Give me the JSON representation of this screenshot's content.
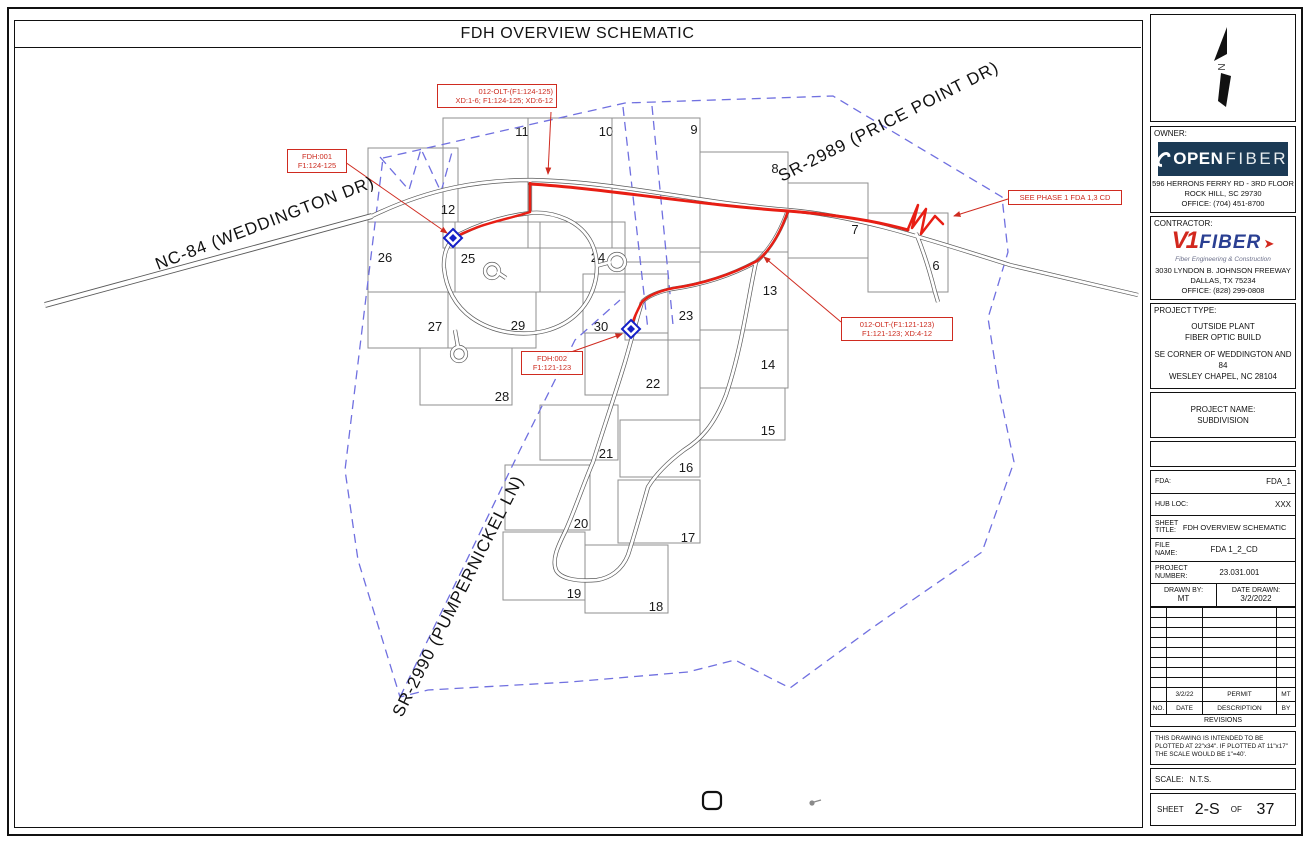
{
  "page": {
    "title": "FDH OVERVIEW SCHEMATIC"
  },
  "map": {
    "streets": [
      {
        "label": "NC-84 (WEDDINGTON DR)"
      },
      {
        "label": "SR-2989 (PRICE POINT DR)"
      },
      {
        "label": "SR-2990 (PUMPERNICKEL LN)"
      }
    ],
    "lots": [
      {
        "n": "11",
        "r": [
          443,
          118,
          85,
          130
        ],
        "p": [
          522,
          131
        ]
      },
      {
        "n": "10",
        "r": [
          528,
          118,
          84,
          130
        ],
        "p": [
          606,
          131
        ]
      },
      {
        "n": "9",
        "r": [
          612,
          118,
          88,
          130
        ],
        "p": [
          694,
          129
        ]
      },
      {
        "n": "8",
        "r": [
          700,
          152,
          88,
          100
        ],
        "p": [
          775,
          168
        ]
      },
      {
        "n": "7",
        "r": [
          788,
          183,
          80,
          75
        ],
        "p": [
          855,
          229
        ]
      },
      {
        "n": "6",
        "r": [
          868,
          213,
          80,
          79
        ],
        "p": [
          936,
          265
        ]
      },
      {
        "n": "12",
        "r": [
          368,
          148,
          90,
          74
        ],
        "p": [
          448,
          209
        ]
      },
      {
        "n": "26",
        "r": [
          368,
          222,
          87,
          70
        ],
        "p": [
          385,
          257
        ]
      },
      {
        "n": "25",
        "r": [
          455,
          222,
          85,
          70
        ],
        "p": [
          468,
          258
        ]
      },
      {
        "n": "24",
        "r": [
          540,
          222,
          85,
          70
        ],
        "p": [
          598,
          257
        ]
      },
      {
        "n": "13",
        "r": [
          700,
          252,
          88,
          78
        ],
        "p": [
          770,
          290
        ]
      },
      {
        "n": "27",
        "r": [
          368,
          292,
          80,
          56
        ],
        "p": [
          435,
          326
        ]
      },
      {
        "n": "29",
        "r": [
          448,
          292,
          88,
          56
        ],
        "p": [
          518,
          325
        ]
      },
      {
        "n": "30",
        "r": [
          583,
          274,
          85,
          59
        ],
        "p": [
          601,
          326
        ]
      },
      {
        "n": "23",
        "r": [
          625,
          262,
          75,
          78
        ],
        "p": [
          686,
          315
        ]
      },
      {
        "n": "14",
        "r": [
          700,
          330,
          88,
          58
        ],
        "p": [
          768,
          364
        ]
      },
      {
        "n": "28",
        "r": [
          420,
          348,
          92,
          57
        ],
        "p": [
          502,
          396
        ]
      },
      {
        "n": "22",
        "r": [
          585,
          333,
          83,
          62
        ],
        "p": [
          653,
          383
        ]
      },
      {
        "n": "15",
        "r": [
          700,
          388,
          85,
          52
        ],
        "p": [
          768,
          430
        ]
      },
      {
        "n": "21",
        "r": [
          540,
          405,
          78,
          55
        ],
        "p": [
          606,
          453
        ]
      },
      {
        "n": "16",
        "r": [
          620,
          420,
          80,
          57
        ],
        "p": [
          686,
          467
        ]
      },
      {
        "n": "20",
        "r": [
          505,
          465,
          85,
          65
        ],
        "p": [
          581,
          523
        ]
      },
      {
        "n": "17",
        "r": [
          618,
          480,
          82,
          63
        ],
        "p": [
          688,
          537
        ]
      },
      {
        "n": "19",
        "r": [
          503,
          532,
          82,
          68
        ],
        "p": [
          574,
          593
        ]
      },
      {
        "n": "18",
        "r": [
          585,
          545,
          83,
          68
        ],
        "p": [
          656,
          606
        ]
      }
    ],
    "callouts": [
      {
        "lines": [
          "012-OLT-(F1:124-125)",
          "XD:1-6; F1:124-125; XD:6-12"
        ]
      },
      {
        "lines": [
          "FDH:001",
          "F1:124-125"
        ]
      },
      {
        "lines": [
          "SEE PHASE 1 FDA 1,3 CD"
        ]
      },
      {
        "lines": [
          "012-OLT-(F1:121-123)",
          "F1:121-123; XD:4-12"
        ]
      },
      {
        "lines": [
          "FDH:002",
          "F1:121-123"
        ]
      }
    ],
    "fdh_points": [
      {
        "id": "FDH:001"
      },
      {
        "id": "FDH:002"
      }
    ]
  },
  "titleblock": {
    "north_letter": "N",
    "owner": {
      "label": "OWNER:",
      "logo": {
        "word1": "OPEN",
        "word2": "FIBER"
      },
      "address": [
        "596 HERRONS FERRY RD - 3RD FLOOR",
        "ROCK HILL, SC 29730",
        "OFFICE: (704) 451-8700"
      ]
    },
    "contractor": {
      "label": "CONTRACTOR:",
      "logo": {
        "v": "V1",
        "word": "FIBER",
        "arrow": "➤",
        "tagline": "Fiber Engineering & Construction"
      },
      "address": [
        "3030 LYNDON B. JOHNSON FREEWAY",
        "DALLAS, TX 75234",
        "OFFICE: (828) 299-0808"
      ]
    },
    "project_type": {
      "label": "PROJECT TYPE:",
      "lines": [
        "OUTSIDE PLANT",
        "FIBER OPTIC BUILD"
      ],
      "location": [
        "SE CORNER OF WEDDINGTON AND",
        "84",
        "WESLEY CHAPEL, NC 28104"
      ]
    },
    "project_name": {
      "label": "PROJECT NAME:",
      "value": "SUBDIVISION"
    },
    "fda": {
      "label": "FDA:",
      "value": "FDA_1"
    },
    "hub": {
      "label": "HUB LOC:",
      "value": "XXX"
    },
    "sheet_title": {
      "label1": "SHEET",
      "label2": "TITLE:",
      "value": "FDH OVERVIEW SCHEMATIC"
    },
    "file_name": {
      "label1": "FILE",
      "label2": "NAME:",
      "value": "FDA 1_2_CD"
    },
    "project_number": {
      "label1": "PROJECT",
      "label2": "NUMBER:",
      "value": "23.031.001"
    },
    "drawn_by": {
      "label": "DRAWN BY:",
      "value": "MT"
    },
    "date_drawn": {
      "label": "DATE DRAWN:",
      "value": "3/2/2022"
    },
    "revisions": {
      "banner": "REVISIONS",
      "headers": [
        "NO.",
        "DATE",
        "DESCRIPTION",
        "BY"
      ],
      "rows": [
        {
          "no": "",
          "date": "3/2/22",
          "desc": "PERMIT",
          "by": "MT"
        }
      ],
      "empty_rows": 8
    },
    "plot_note": "THIS DRAWING IS INTENDED TO BE PLOTTED AT 22\"x34\". IF PLOTTED AT 11\"x17\" THE SCALE WOULD BE 1\"=40'.",
    "scale": {
      "label": "SCALE:",
      "value": "N.T.S."
    },
    "sheet": {
      "label": "SHEET",
      "number": "2-S",
      "of": "OF",
      "total": "37"
    }
  }
}
